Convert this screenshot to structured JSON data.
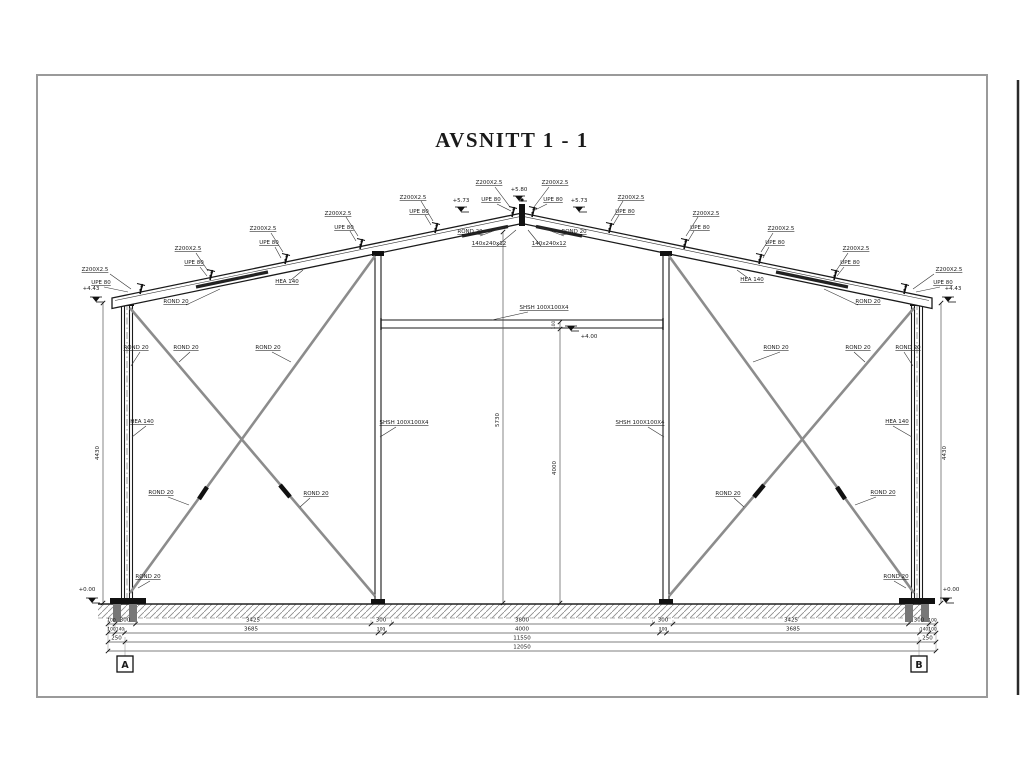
{
  "title": "AVSNITT 1 - 1",
  "labels": {
    "purlin": "Z200X2.5",
    "purlin_upe": "UPE 80",
    "brace": "ROND 20",
    "frame": "HEA 140",
    "post": "SHSH 100X100X4",
    "plate": "140x240x12"
  },
  "elevations": {
    "ridge": "+5.80",
    "ridge_side": "+5.73",
    "eave": "+4.43",
    "door": "+4.00",
    "ground": "+0.00"
  },
  "dims": {
    "column": "4430",
    "ridge": "5730",
    "door": "4000",
    "lintel": "100",
    "row1": [
      "100",
      "300",
      "3425",
      "300",
      "3800",
      "300",
      "3425",
      "300",
      "100"
    ],
    "row2": [
      "100",
      "140",
      "3685",
      "100",
      "4000",
      "100",
      "3685",
      "140",
      "100"
    ],
    "row3": [
      "250",
      "11550",
      "250"
    ],
    "total": "12050"
  },
  "grid": {
    "left": "A",
    "right": "B"
  }
}
